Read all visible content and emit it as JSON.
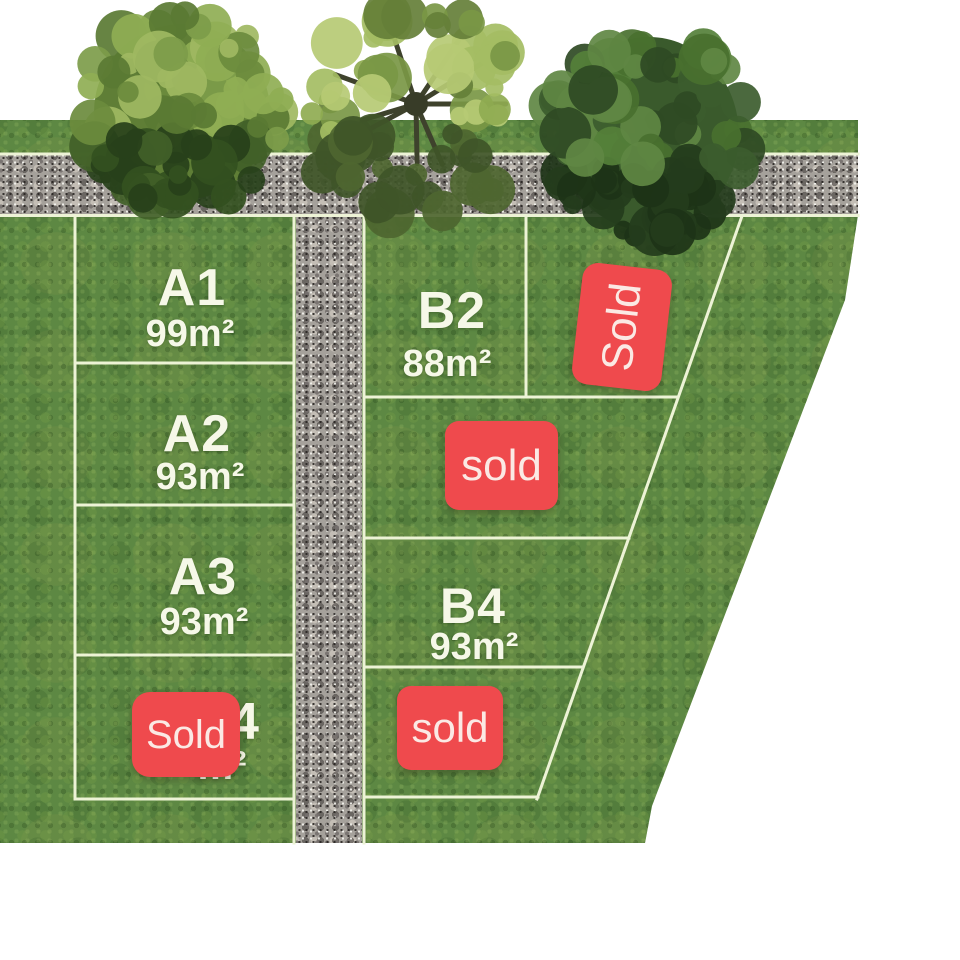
{
  "scene": {
    "type": "land-subdivision-site-plan",
    "background": "#ffffff"
  },
  "colors": {
    "grass": "#5d8843",
    "road": "#a5a19b",
    "boundary_line": "#edf3d6",
    "badge_red": "#ef4a4d",
    "badge_text": "#fbe9e4",
    "label_text": "#f6f8e8"
  },
  "plots": {
    "a1": {
      "code": "A1",
      "area": "99m²"
    },
    "a2": {
      "code": "A2",
      "area": "93m²"
    },
    "a3": {
      "code": "A3",
      "area": "93m²"
    },
    "a4": {
      "code_fragment": "4",
      "area_fragment": "m²",
      "badge": "Sold"
    },
    "b2": {
      "code": "B2",
      "area": "88m²"
    },
    "b_right": {
      "badge": "Sold"
    },
    "b_mid": {
      "badge": "sold"
    },
    "b4": {
      "code": "B4",
      "area": "93m²"
    },
    "b_bottom": {
      "badge": "sold"
    }
  }
}
